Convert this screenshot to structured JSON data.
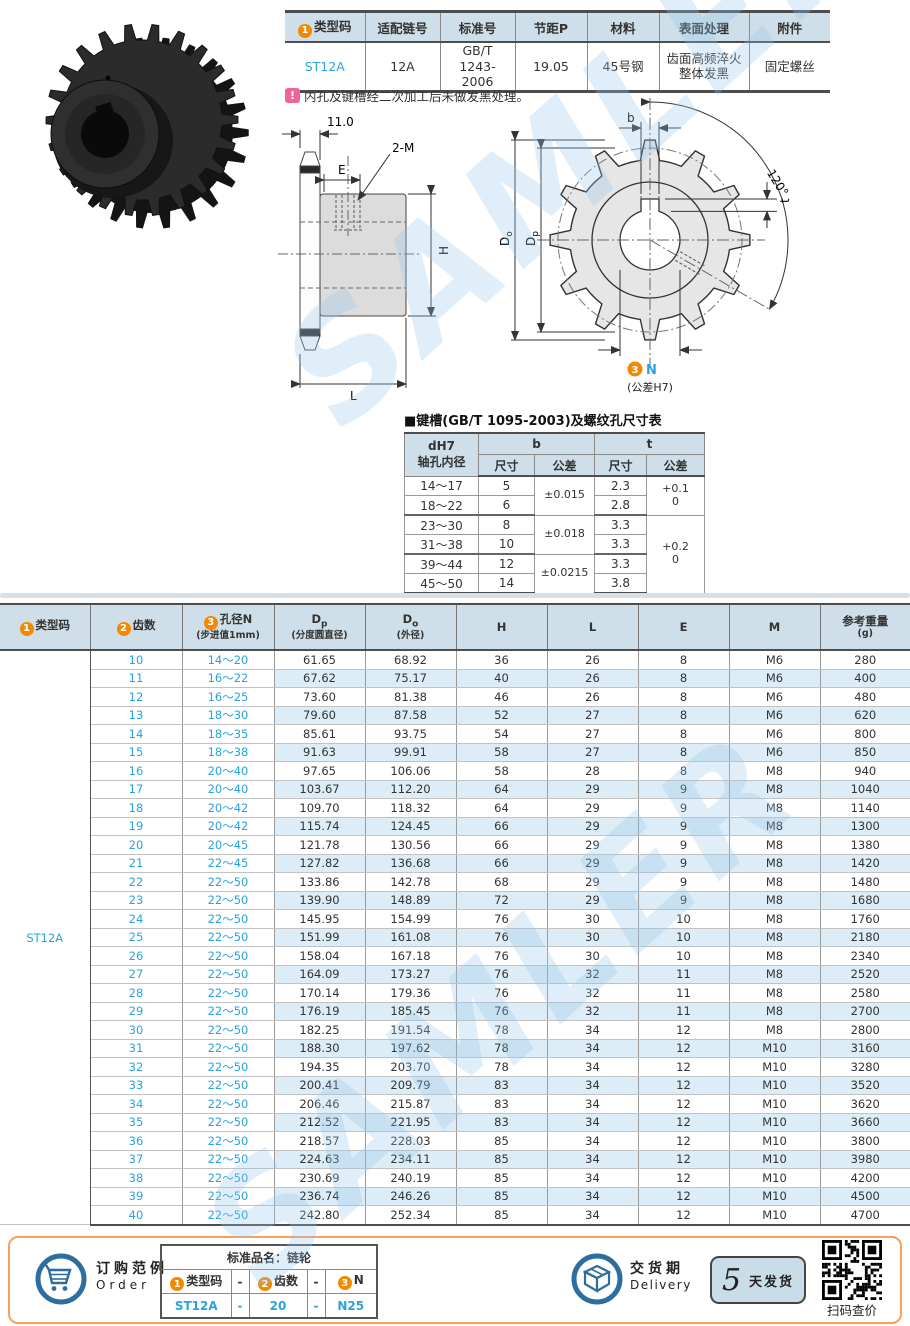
{
  "watermark": "SAMLER",
  "colors": {
    "accent_orange": "#f18a00",
    "accent_blue": "#29a3dc",
    "header_bg": "#cfdfe9",
    "row_alt_bg": "#ddedf7",
    "footer_border_orange": "#f5a060",
    "icon_blue": "#2d6e9e",
    "note_pink": "#f0649b"
  },
  "spec_table": {
    "headers": [
      {
        "badge": "1",
        "text": "类型码"
      },
      {
        "text": "适配链号"
      },
      {
        "text": "标准号"
      },
      {
        "text": "节距P"
      },
      {
        "text": "材料"
      },
      {
        "text": "表面处理"
      },
      {
        "text": "附件"
      }
    ],
    "values": [
      "ST12A",
      "12A",
      "GB/T 1243-\n2006",
      "19.05",
      "45号钢",
      "齿面高频淬火\n整体发黑",
      "固定螺丝"
    ]
  },
  "note": {
    "icon": "!",
    "text": "内孔及键槽经二次加工后未做发黑处理。"
  },
  "side_view": {
    "width_dim": "11.0",
    "e_dim": "E",
    "tap_label": "2-M",
    "h_dim": "H",
    "l_dim": "L"
  },
  "front_view": {
    "b_dim": "b",
    "t_dim": "t",
    "angle": "120°",
    "outer_main": "D",
    "outer_sub": "o",
    "pitch_main": "D",
    "pitch_sub": "p",
    "bore_badge": "3",
    "bore_label": "N",
    "bore_tol": "(公差H7)"
  },
  "keyway_table": {
    "title": "■键槽(GB/T 1095-2003)及螺纹孔尺寸表",
    "col1_header": "dH7\n轴孔内径",
    "group_headers": [
      "b",
      "t"
    ],
    "sub_headers": [
      "尺寸",
      "公差",
      "尺寸",
      "公差"
    ],
    "rows": [
      [
        "14～17",
        "5",
        "2.3"
      ],
      [
        "18～22",
        "6",
        "2.8"
      ],
      [
        "23～30",
        "8",
        "3.3"
      ],
      [
        "31～38",
        "10",
        "3.3"
      ],
      [
        "39～44",
        "12",
        "3.3"
      ],
      [
        "45～50",
        "14",
        "3.8"
      ]
    ],
    "b_tolerance": [
      {
        "span": 2,
        "text": "±0.015"
      },
      {
        "span": 2,
        "text": "±0.018"
      },
      {
        "span": 2,
        "text": "±0.0215"
      }
    ],
    "t_tolerance": [
      {
        "span": 2,
        "text": "+0.1\n0"
      },
      {
        "span": 4,
        "text": "+0.2\n0"
      }
    ]
  },
  "main_table": {
    "type_code": "ST12A",
    "headers": [
      {
        "badge": "1",
        "text": "类型码"
      },
      {
        "badge": "2",
        "text": "齿数"
      },
      {
        "badge": "3",
        "text": "孔径N",
        "sub": "(步进值1mm)"
      },
      {
        "text": "D",
        "subscript": "p",
        "sub": "(分度圆直径)"
      },
      {
        "text": "D",
        "subscript": "o",
        "sub": "(外径)"
      },
      {
        "text": "H"
      },
      {
        "text": "L"
      },
      {
        "text": "E"
      },
      {
        "text": "M"
      },
      {
        "text": "参考重量",
        "sub": "(g)"
      }
    ],
    "rows": [
      [
        10,
        "14～20",
        "61.65",
        "68.92",
        36,
        26,
        8,
        "M6",
        280
      ],
      [
        11,
        "16～22",
        "67.62",
        "75.17",
        40,
        26,
        8,
        "M6",
        400
      ],
      [
        12,
        "16～25",
        "73.60",
        "81.38",
        46,
        26,
        8,
        "M6",
        480
      ],
      [
        13,
        "18～30",
        "79.60",
        "87.58",
        52,
        27,
        8,
        "M6",
        620
      ],
      [
        14,
        "18～35",
        "85.61",
        "93.75",
        54,
        27,
        8,
        "M6",
        800
      ],
      [
        15,
        "18～38",
        "91.63",
        "99.91",
        58,
        27,
        8,
        "M6",
        850
      ],
      [
        16,
        "20～40",
        "97.65",
        "106.06",
        58,
        28,
        8,
        "M8",
        940
      ],
      [
        17,
        "20～40",
        "103.67",
        "112.20",
        64,
        29,
        9,
        "M8",
        1040
      ],
      [
        18,
        "20～42",
        "109.70",
        "118.32",
        64,
        29,
        9,
        "M8",
        1140
      ],
      [
        19,
        "20～42",
        "115.74",
        "124.45",
        66,
        29,
        9,
        "M8",
        1300
      ],
      [
        20,
        "20～45",
        "121.78",
        "130.56",
        66,
        29,
        9,
        "M8",
        1380
      ],
      [
        21,
        "22～45",
        "127.82",
        "136.68",
        66,
        29,
        9,
        "M8",
        1420
      ],
      [
        22,
        "22～50",
        "133.86",
        "142.78",
        68,
        29,
        9,
        "M8",
        1480
      ],
      [
        23,
        "22～50",
        "139.90",
        "148.89",
        72,
        29,
        9,
        "M8",
        1680
      ],
      [
        24,
        "22～50",
        "145.95",
        "154.99",
        76,
        30,
        10,
        "M8",
        1760
      ],
      [
        25,
        "22～50",
        "151.99",
        "161.08",
        76,
        30,
        10,
        "M8",
        2180
      ],
      [
        26,
        "22～50",
        "158.04",
        "167.18",
        76,
        30,
        10,
        "M8",
        2340
      ],
      [
        27,
        "22～50",
        "164.09",
        "173.27",
        76,
        32,
        11,
        "M8",
        2520
      ],
      [
        28,
        "22～50",
        "170.14",
        "179.36",
        76,
        32,
        11,
        "M8",
        2580
      ],
      [
        29,
        "22～50",
        "176.19",
        "185.45",
        76,
        32,
        11,
        "M8",
        2700
      ],
      [
        30,
        "22～50",
        "182.25",
        "191.54",
        78,
        34,
        12,
        "M8",
        2800
      ],
      [
        31,
        "22～50",
        "188.30",
        "197.62",
        78,
        34,
        12,
        "M10",
        3160
      ],
      [
        32,
        "22～50",
        "194.35",
        "203.70",
        78,
        34,
        12,
        "M10",
        3280
      ],
      [
        33,
        "22～50",
        "200.41",
        "209.79",
        83,
        34,
        12,
        "M10",
        3520
      ],
      [
        34,
        "22～50",
        "206.46",
        "215.87",
        83,
        34,
        12,
        "M10",
        3620
      ],
      [
        35,
        "22～50",
        "212.52",
        "221.95",
        83,
        34,
        12,
        "M10",
        3660
      ],
      [
        36,
        "22～50",
        "218.57",
        "228.03",
        85,
        34,
        12,
        "M10",
        3800
      ],
      [
        37,
        "22～50",
        "224.63",
        "234.11",
        85,
        34,
        12,
        "M10",
        3980
      ],
      [
        38,
        "22～50",
        "230.69",
        "240.19",
        85,
        34,
        12,
        "M10",
        4200
      ],
      [
        39,
        "22～50",
        "236.74",
        "246.26",
        85,
        34,
        12,
        "M10",
        4500
      ],
      [
        40,
        "22～50",
        "242.80",
        "252.34",
        85,
        34,
        12,
        "M10",
        4700
      ]
    ]
  },
  "footer": {
    "order_title": "订购范例",
    "order_en": "Order",
    "order_table": {
      "title": "标准品名：链轮",
      "headers": [
        {
          "badge": "1",
          "text": "类型码"
        },
        {
          "text": "-"
        },
        {
          "badge": "2",
          "text": "齿数"
        },
        {
          "text": "-"
        },
        {
          "badge": "3",
          "text": "N"
        }
      ],
      "values": [
        "ST12A",
        "-",
        "20",
        "-",
        "N25"
      ]
    },
    "delivery_title": "交货期",
    "delivery_en": "Delivery",
    "delivery_days": "5",
    "delivery_unit": "天发货",
    "qr_label": "扫码查价"
  }
}
